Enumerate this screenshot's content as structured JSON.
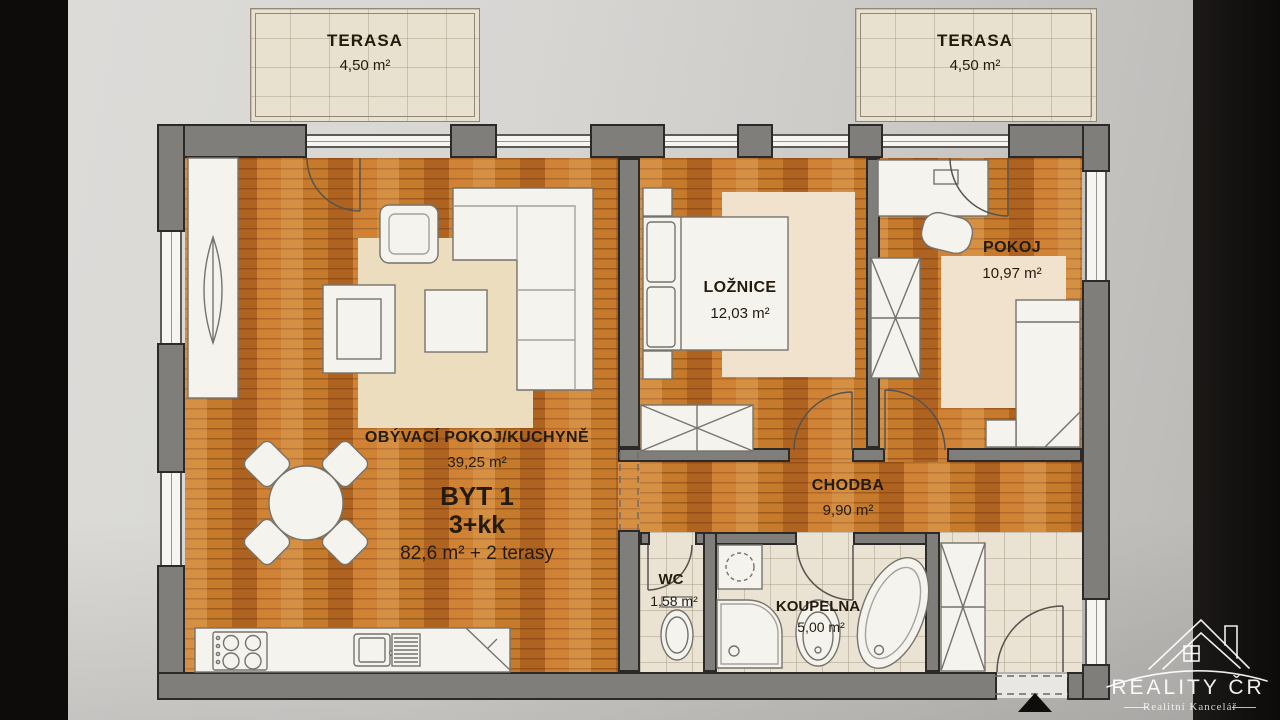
{
  "terraces": {
    "left": {
      "name": "TERASA",
      "area": "4,50 m²"
    },
    "right": {
      "name": "TERASA",
      "area": "4,50 m²"
    }
  },
  "rooms": {
    "living": {
      "name": "OBÝVACÍ POKOJ/KUCHYNĚ",
      "area": "39,25 m²"
    },
    "bedroom": {
      "name": "LOŽNICE",
      "area": "12,03 m²"
    },
    "kidsroom": {
      "name": "POKOJ",
      "area": "10,97 m²"
    },
    "hallway": {
      "name": "CHODBA",
      "area": "9,90 m²"
    },
    "wc": {
      "name": "WC",
      "area": "1,58 m²"
    },
    "bathroom": {
      "name": "KOUPELNA",
      "area": "5,00 m²"
    }
  },
  "unit": {
    "title": "BYT 1",
    "disposition": "3+kk",
    "total_area": "82,6 m² + 2 terasy"
  },
  "brand": {
    "name": "REALITY ČR",
    "tagline": "Realitní Kancelář"
  },
  "colors": {
    "wood_floor": "#c67a2b",
    "tile_floor": "#eae3d3",
    "wall": "#807e7b",
    "terrace": "#e9e1d0",
    "side_bars": "#0d0c0b",
    "label_text": "#241b0e",
    "logo_text": "#f5f4f2"
  }
}
